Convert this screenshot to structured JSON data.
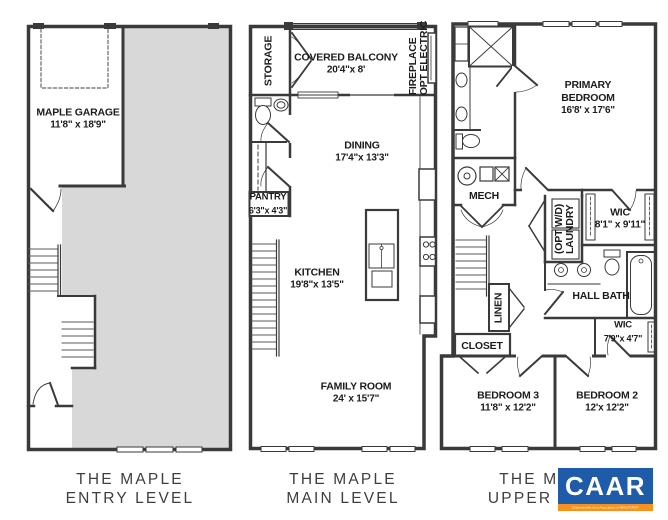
{
  "document": {
    "type": "floor-plan-sheet",
    "plan_name": "THE MAPLE"
  },
  "colors": {
    "walls": "#3a3a3a",
    "floor_gray": "#d8d8d8",
    "logo_blue": "#1e5ca9",
    "logo_orange": "#f6921e"
  },
  "levels": {
    "entry": {
      "caption": {
        "line1": "THE MAPLE",
        "line2": "ENTRY LEVEL"
      },
      "rooms": {
        "garage": {
          "name": "MAPLE GARAGE",
          "dims": "11'8\" x 18'9\""
        }
      }
    },
    "main": {
      "caption": {
        "line1": "THE MAPLE",
        "line2": "MAIN LEVEL"
      },
      "rooms": {
        "storage": {
          "name": "STORAGE"
        },
        "covered_balcony": {
          "name": "COVERED BALCONY",
          "dims": "20'4\"x 8'"
        },
        "fireplace": {
          "name": "OPT ELECTRIC",
          "name2": "FIREPLACE"
        },
        "dining": {
          "name": "DINING",
          "dims": "17'4\"x 13'3\""
        },
        "pantry": {
          "name": "PANTRY",
          "dims": "6'3\"x 4'3\""
        },
        "kitchen": {
          "name": "KITCHEN",
          "dims": "19'8\"x 13'5\""
        },
        "family_room": {
          "name": "FAMILY ROOM",
          "dims": "24' x 15'7\""
        }
      }
    },
    "upper": {
      "caption": {
        "line1": "THE MAPLE",
        "line2": "UPPER LEVEL"
      },
      "rooms": {
        "primary_bedroom": {
          "name": "PRIMARY",
          "name2": "BEDROOM",
          "dims": "16'8' x 17'6\""
        },
        "mech": {
          "name": "MECH"
        },
        "wic_primary": {
          "name": "WIC",
          "dims": "8'1\" x 9'11\""
        },
        "laundry": {
          "name": "LAUNDRY",
          "name2": "(OPT W/D)"
        },
        "linen": {
          "name": "LINEN"
        },
        "hall_bath": {
          "name": "HALL BATH"
        },
        "closet": {
          "name": "CLOSET"
        },
        "wic_hall": {
          "name": "WIC",
          "dims": "7'9\"x 4'7\""
        },
        "bedroom3": {
          "name": "BEDROOM 3",
          "dims": "11'8\" x 12'2\""
        },
        "bedroom2": {
          "name": "BEDROOM 2",
          "dims": "12'x 12'2\""
        }
      }
    }
  },
  "logo": {
    "name": "CAAR",
    "tagline": "Charlottesville Area Association of REALTORS®"
  }
}
